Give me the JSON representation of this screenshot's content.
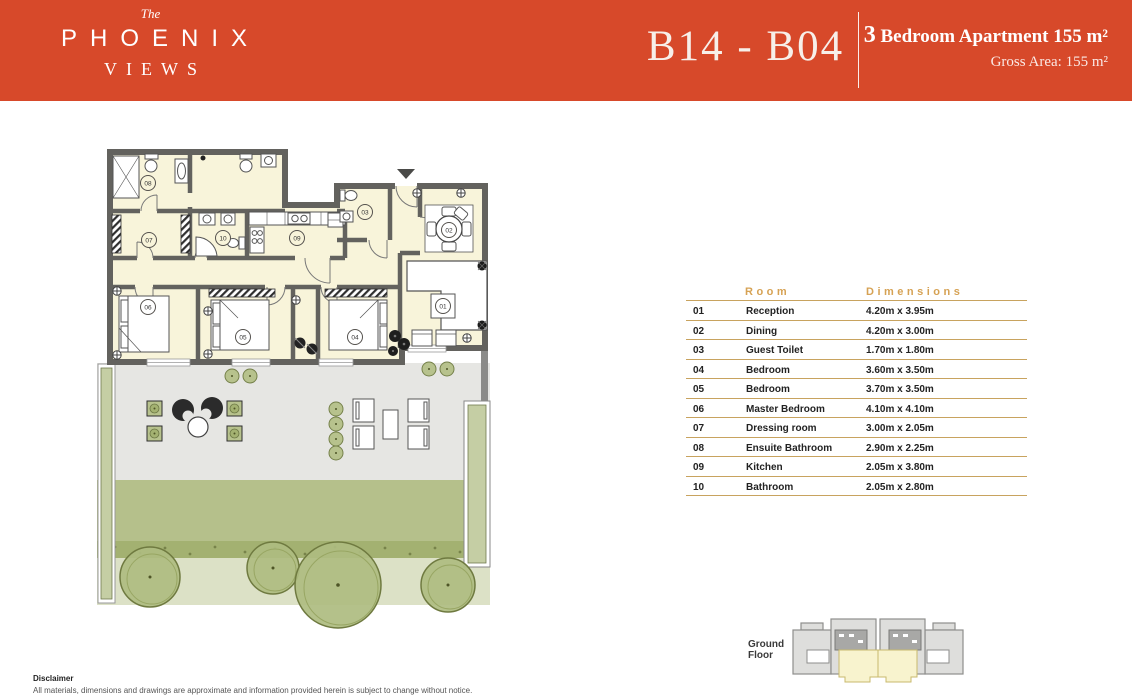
{
  "header": {
    "brand": {
      "the": "The",
      "name": "PHOENIX",
      "sub": "VIEWS"
    },
    "unit_code": "B14 - B04",
    "apartment_number": "3",
    "apartment_title": " Bedroom Apartment 155 m²",
    "gross_area": "Gross Area: 155 m²"
  },
  "table": {
    "headers": {
      "room": "Room",
      "dimensions": "Dimensions"
    },
    "rows": [
      {
        "no": "01",
        "room": "Reception",
        "dimensions": "4.20m x 3.95m"
      },
      {
        "no": "02",
        "room": "Dining",
        "dimensions": "4.20m x 3.00m"
      },
      {
        "no": "03",
        "room": "Guest Toilet",
        "dimensions": "1.70m x 1.80m"
      },
      {
        "no": "04",
        "room": "Bedroom",
        "dimensions": "3.60m x 3.50m"
      },
      {
        "no": "05",
        "room": "Bedroom",
        "dimensions": "3.70m x 3.50m"
      },
      {
        "no": "06",
        "room": "Master Bedroom",
        "dimensions": "4.10m x 4.10m"
      },
      {
        "no": "07",
        "room": "Dressing room",
        "dimensions": "3.00m x 2.05m"
      },
      {
        "no": "08",
        "room": "Ensuite Bathroom",
        "dimensions": "2.90m x 2.25m"
      },
      {
        "no": "09",
        "room": "Kitchen",
        "dimensions": "2.05m x 3.80m"
      },
      {
        "no": "10",
        "room": "Bathroom",
        "dimensions": "2.05m x 2.80m"
      }
    ]
  },
  "minimap": {
    "label_line1": "Ground",
    "label_line2": "Floor"
  },
  "disclaimer": {
    "title": "Disclaimer",
    "text": "All materials, dimensions and drawings are approximate and information provided herein is subject to change without notice."
  },
  "colors": {
    "accent": "#D7492A",
    "gold": "#D6A254",
    "gold_line": "#C8A35F",
    "wall": "#63625E",
    "floor": "#F8F4DA",
    "terrace": "#E6E6E3",
    "garden": "#B5C08B",
    "light_green": "#DCE1C6",
    "tree": "#AEBC80",
    "sage": "#C5CEA4",
    "highlight": "#F8F3CE"
  }
}
